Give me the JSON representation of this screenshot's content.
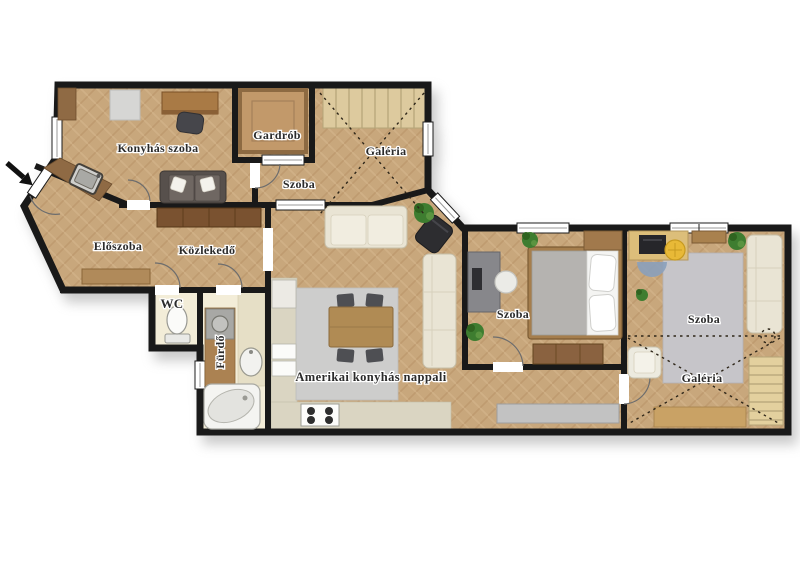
{
  "plan": {
    "type": "apartment-floor-plan",
    "language": "hu",
    "labels": {
      "konyhas_szoba": "Konyhás szoba",
      "gardrob": "Gardrób",
      "galeria_top": "Galéria",
      "szoba_top": "Szoba",
      "eloszoba": "Előszoba",
      "kozlekedo": "Közlekedő",
      "wc": "WC",
      "furdo": "Fürdő",
      "nappali": "Amerikai konyhás nappali",
      "szoba_middle": "Szoba",
      "szoba_right": "Szoba",
      "galeria_right": "Galéria"
    },
    "icons": {
      "entrance": "entrance-arrow"
    },
    "colors": {
      "wall": "#191919",
      "floor_parquet": "#c8a77c",
      "floor_parquet_shade": "#b58f63",
      "floor_parquet_light": "#d7ba90",
      "floor_bathroom": "#f3edd8",
      "rug_gray": "#cdcdcc",
      "kitchen_counter": "#dad5c2",
      "wood_dark": "#7a5230",
      "wood_mid": "#a1794c",
      "wood_table": "#b08b54",
      "sofa_cream": "#e9e4d4",
      "sofa_dark": "#57504c",
      "stairs": "#ddca9e",
      "plant": "#3e7d30",
      "stool_yellow": "#e8b937",
      "rug_blue": "#8aa0bb",
      "appliance_gray": "#a8a8a5",
      "label_text": "#2b2b2b"
    }
  }
}
